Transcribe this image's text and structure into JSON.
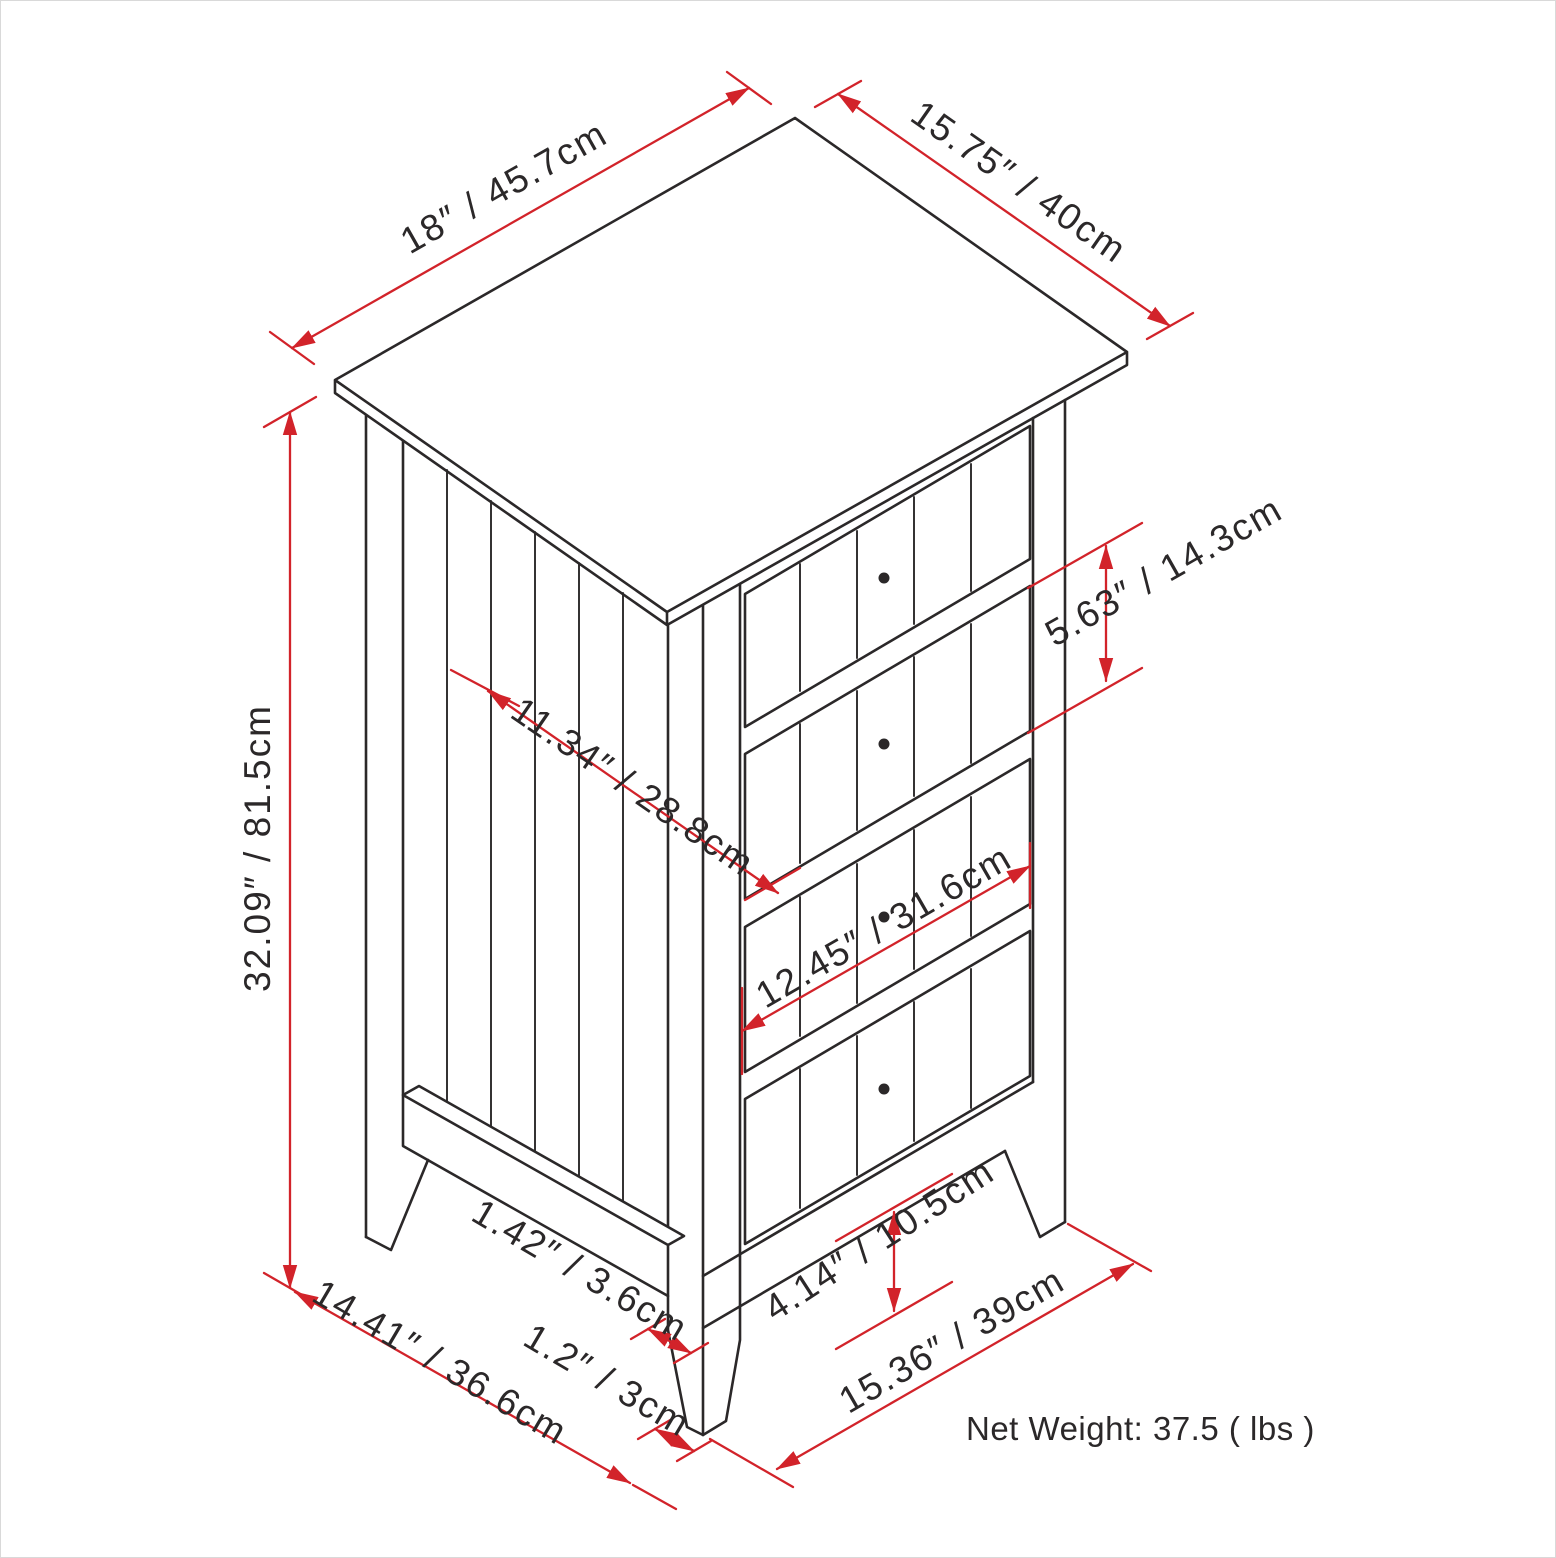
{
  "diagram_type": "furniture dimension drawing",
  "cabinet": {
    "drawers": 4,
    "knobs_per_drawer": 1
  },
  "dimensions": {
    "top_width": {
      "label": "18″ / 45.7cm",
      "inches": "18",
      "cm": "45.7"
    },
    "top_depth": {
      "label": "15.75″ / 40cm",
      "inches": "15.75",
      "cm": "40"
    },
    "height": {
      "label": "32.09″ / 81.5cm",
      "inches": "32.09",
      "cm": "81.5"
    },
    "side_panel_width": {
      "label": "11.34″ / 28.8cm",
      "inches": "11.34",
      "cm": "28.8"
    },
    "drawer_height": {
      "label": "5.63″ / 14.3cm",
      "inches": "5.63",
      "cm": "14.3"
    },
    "drawer_width": {
      "label": "12.45″ / 31.6cm",
      "inches": "12.45",
      "cm": "31.6"
    },
    "leg_top_width": {
      "label": "1.42″ / 3.6cm",
      "inches": "1.42",
      "cm": "3.6"
    },
    "leg_bottom_width": {
      "label": "1.2″ / 3cm",
      "inches": "1.2",
      "cm": "3"
    },
    "floor_depth": {
      "label": "14.41″ / 36.6cm",
      "inches": "14.41",
      "cm": "36.6"
    },
    "floor_clearance": {
      "label": "4.14″ / 10.5cm",
      "inches": "4.14",
      "cm": "10.5"
    },
    "floor_width": {
      "label": "15.36″ / 39cm",
      "inches": "15.36",
      "cm": "39"
    }
  },
  "net_weight": {
    "label": "Net Weight: 37.5 ( lbs )",
    "value": "37.5",
    "unit": "lbs"
  },
  "colors": {
    "dimension_red": "#d2232a",
    "line_ink": "#2b2829",
    "background": "#ffffff",
    "frame_border": "#d9d9d9"
  }
}
